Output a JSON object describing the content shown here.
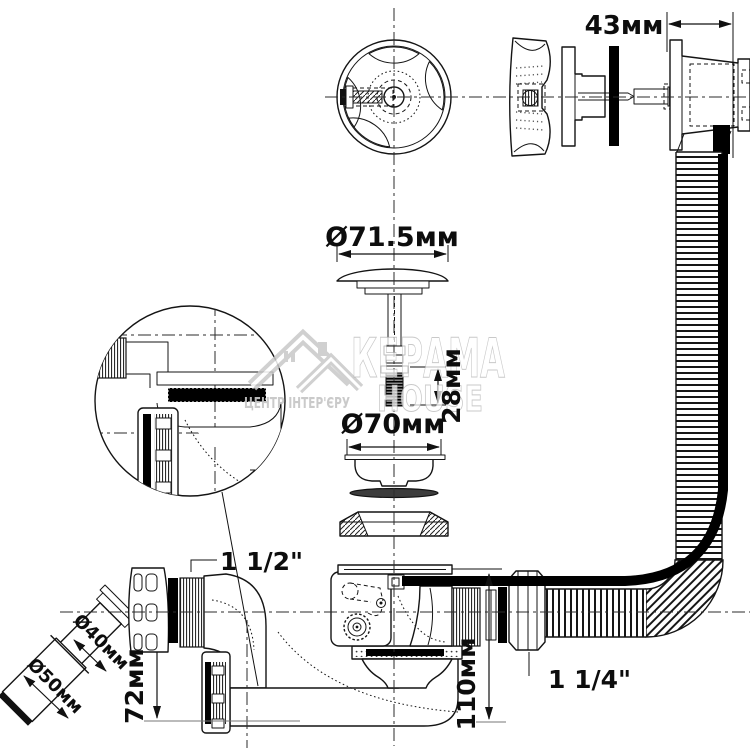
{
  "watermark": {
    "brand": "КЕРАМА",
    "brand_sub": "HOUSE",
    "tagline": "ЦЕНТР ІНТЕР'ЄРУ"
  },
  "dimensions": {
    "overflow_body_width": "43мм",
    "plug_cap_diameter": "Ø71.5мм",
    "adjust_screw_height": "28мм",
    "waste_flange_diameter": "Ø70мм",
    "drain_inlet_thread": "1 1/2\"",
    "outlet_pipe_diameter": "Ø40мм",
    "outlet_end_diameter": "Ø50мм",
    "trap_depth": "72мм",
    "body_height": "110мм",
    "overflow_nut_thread": "1 1/4\""
  }
}
